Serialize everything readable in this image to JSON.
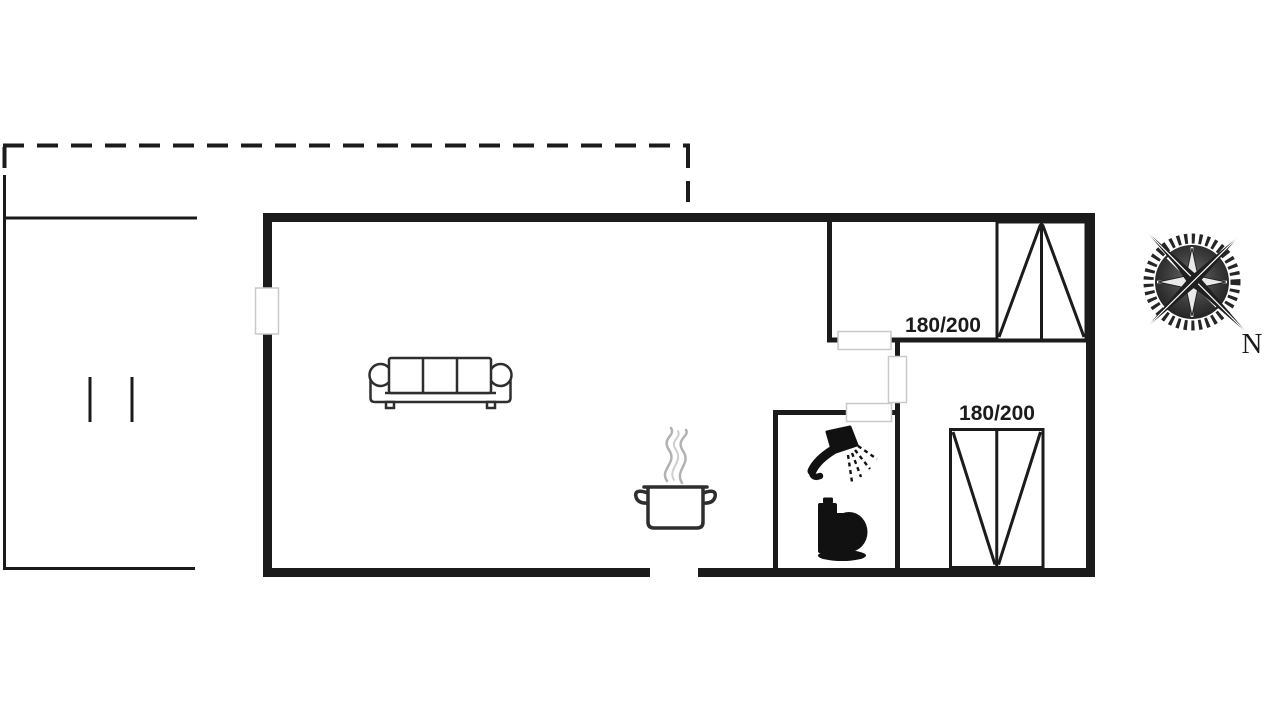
{
  "labels": {
    "bed_top": "180/200",
    "bed_bottom": "180/200",
    "compass_north": "N"
  },
  "icons": {
    "sofa": "sofa-icon",
    "cooking_pot": "cooking-pot-icon",
    "steam": "steam-icon",
    "shower": "shower-icon",
    "toilet": "toilet-icon",
    "bed_top": "double-bed-icon",
    "bed_bottom": "double-bed-icon",
    "compass": "compass-rose-icon"
  },
  "colors": {
    "background": "#ffffff",
    "wall": "#1b1b1b",
    "furniture": "#2e2e2e",
    "fixture": "#111111",
    "steam": "#b2b2b2",
    "door-fill": "#ffffff",
    "door-border": "#c9c9c9",
    "text": "#1b1b1b"
  }
}
